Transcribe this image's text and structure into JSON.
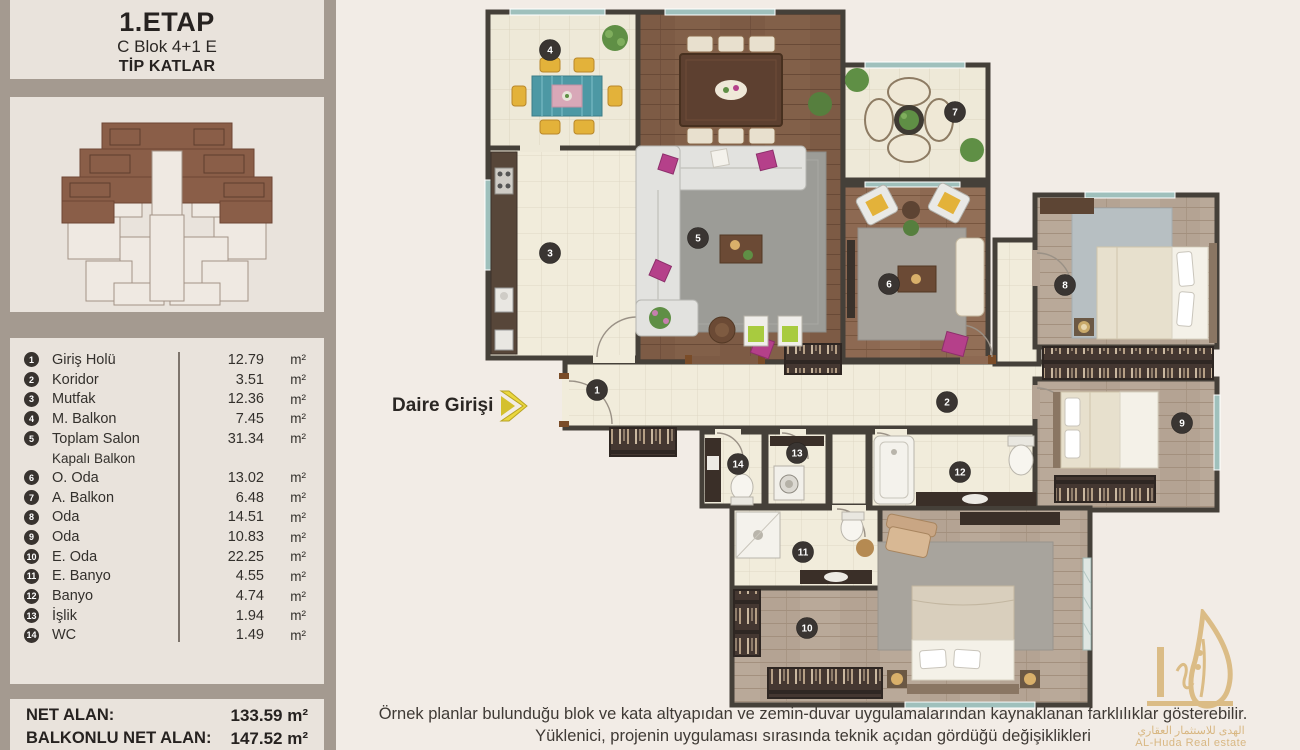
{
  "sidebar": {
    "header": {
      "stage": "1.ETAP",
      "block": "C Blok 4+1 E",
      "floors": "TİP KATLAR"
    },
    "legend": {
      "rows": [
        {
          "num": "1",
          "name": "Giriş Holü",
          "value": "12.79",
          "unit": "m²"
        },
        {
          "num": "2",
          "name": "Koridor",
          "value": "3.51",
          "unit": "m²"
        },
        {
          "num": "3",
          "name": "Mutfak",
          "value": "12.36",
          "unit": "m²"
        },
        {
          "num": "4",
          "name": "M. Balkon",
          "value": "7.45",
          "unit": "m²"
        },
        {
          "num": "5",
          "name": "Toplam Salon",
          "value": "31.34",
          "unit": "m²"
        },
        {
          "sub": true,
          "name": "Kapalı Balkon"
        },
        {
          "num": "6",
          "name": "O. Oda",
          "value": "13.02",
          "unit": "m²"
        },
        {
          "num": "7",
          "name": "A. Balkon",
          "value": "6.48",
          "unit": "m²"
        },
        {
          "num": "8",
          "name": "Oda",
          "value": "14.51",
          "unit": "m²"
        },
        {
          "num": "9",
          "name": "Oda",
          "value": "10.83",
          "unit": "m²"
        },
        {
          "num": "10",
          "name": "E. Oda",
          "value": "22.25",
          "unit": "m²"
        },
        {
          "num": "11",
          "name": "E. Banyo",
          "value": "4.55",
          "unit": "m²"
        },
        {
          "num": "12",
          "name": "Banyo",
          "value": "4.74",
          "unit": "m²"
        },
        {
          "num": "13",
          "name": "İşlik",
          "value": "1.94",
          "unit": "m²"
        },
        {
          "num": "14",
          "name": "WC",
          "value": "1.49",
          "unit": "m²"
        }
      ]
    },
    "totals": [
      {
        "label": "NET ALAN:",
        "value": "133.59 m²"
      },
      {
        "label": "BALKONLU NET ALAN:",
        "value": "147.52 m²"
      }
    ]
  },
  "plan": {
    "entry_label": "Daire Girişi",
    "badges": [
      {
        "num": "1",
        "room": "Giriş Holü"
      },
      {
        "num": "2",
        "room": "Koridor"
      },
      {
        "num": "3",
        "room": "Mutfak"
      },
      {
        "num": "4",
        "room": "M. Balkon"
      },
      {
        "num": "5",
        "room": "Toplam Salon"
      },
      {
        "num": "6",
        "room": "O. Oda"
      },
      {
        "num": "7",
        "room": "A. Balkon"
      },
      {
        "num": "8",
        "room": "Oda"
      },
      {
        "num": "9",
        "room": "Oda"
      },
      {
        "num": "10",
        "room": "E. Oda"
      },
      {
        "num": "11",
        "room": "E. Banyo"
      },
      {
        "num": "12",
        "room": "Banyo"
      },
      {
        "num": "13",
        "room": "İşlik"
      },
      {
        "num": "14",
        "room": "WC"
      }
    ]
  },
  "footer": {
    "line1": "Örnek planlar bulunduğu blok ve kata altyapıdan ve zemin-duvar uygulamalarından kaynaklanan farklılıklar gösterebilir.",
    "line2": "Yüklenici, projenin uygulaması sırasında teknik açıdan gördüğü değişiklikleri"
  },
  "watermark": {
    "arabic": "الهدى للاستثمار العقاري",
    "latin": "AL-Huda Real estate"
  }
}
